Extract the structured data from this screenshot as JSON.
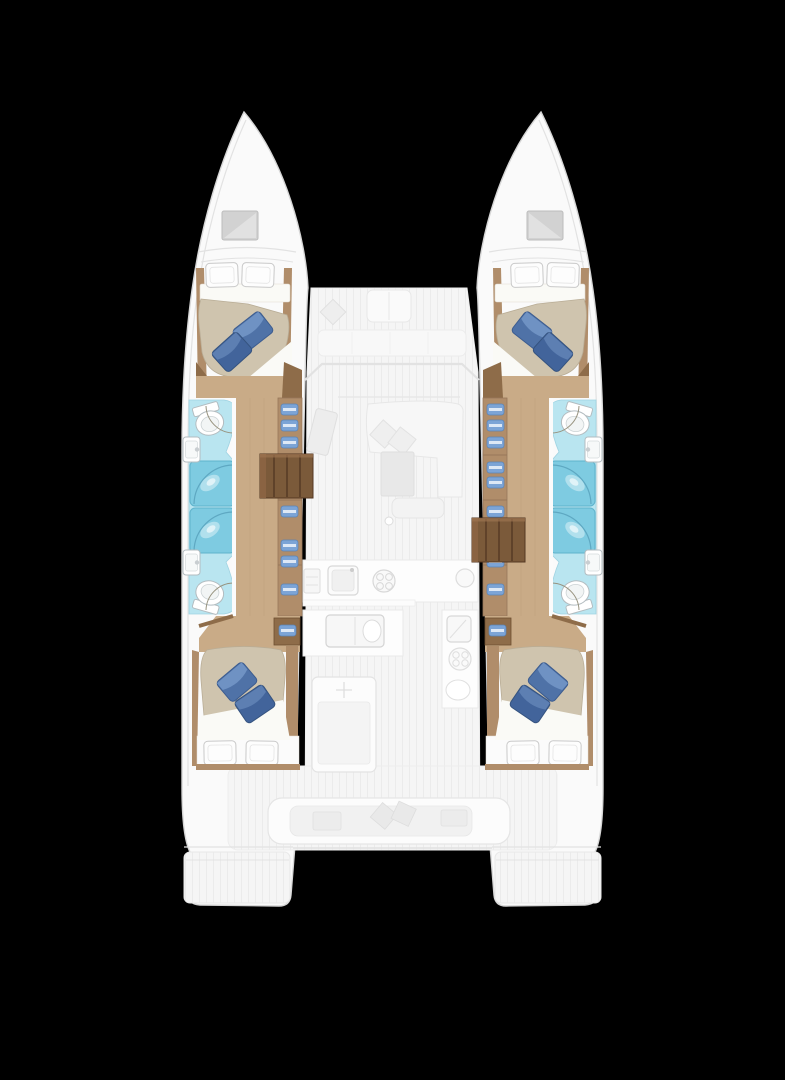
{
  "meta": {
    "title": "Catamaran yacht floor plan, top-down view, four-cabin layout",
    "view": "deck-plan"
  },
  "colors": {
    "background": "#000000",
    "hull_white": "#fafafa",
    "hull_outline": "#d6d6d6",
    "deck_stripe_light": "#f5f5f5",
    "deck_stripe_dark": "#ebebeb",
    "ghost_line": "#e2e2e2",
    "ghost_fill": "#efefef",
    "wood_floor": "#c9ab87",
    "wood_mid": "#b08d6a",
    "wood_dark": "#8e6c49",
    "stair_wood": "#7b5a3a",
    "stair_line": "#543823",
    "bed_duvet": "#cfc4ae",
    "bed_duvet_line": "#b9ad96",
    "sheet_white": "#fafaf6",
    "pillow_white": "#fdfdfd",
    "pillow_blue": "#4f72a7",
    "pillow_blue_hi": "#6f92c3",
    "pillow_blue_dark": "#42649b",
    "pillow_blue_dark_hi": "#5d7fb2",
    "pillow_blue_line": "#35537f",
    "wet_floor": "#b9e5f0",
    "wet_floor_line": "#9fd3e2",
    "shower": "#7ecbe1",
    "shower_line": "#5fb3cc",
    "fixture_line": "#b3bcc0",
    "towel_blue": "#7ca4d6",
    "door_arc": "#97927e",
    "hatch_gray": "#d2d2d2"
  },
  "rooms": [
    "port-forward-cabin",
    "port-forward-bathroom",
    "port-shower-stalls",
    "port-aft-bathroom",
    "port-aft-cabin",
    "starboard-forward-cabin",
    "starboard-forward-bathroom",
    "starboard-shower-stalls",
    "starboard-aft-bathroom",
    "starboard-aft-cabin",
    "saloon",
    "galley",
    "navigation-station",
    "forward-cockpit",
    "aft-cockpit",
    "port-swim-platform",
    "starboard-swim-platform"
  ],
  "features": {
    "hulls": 2,
    "double_beds": 4,
    "blue_accent_pillows_per_bed": 2,
    "white_pillows_per_bed": 2,
    "toilets": 4,
    "washbasins": 4,
    "shower_stalls": 4,
    "stairways": 2,
    "bow_hatches": 2,
    "cockpit_bench_seats": 2
  }
}
